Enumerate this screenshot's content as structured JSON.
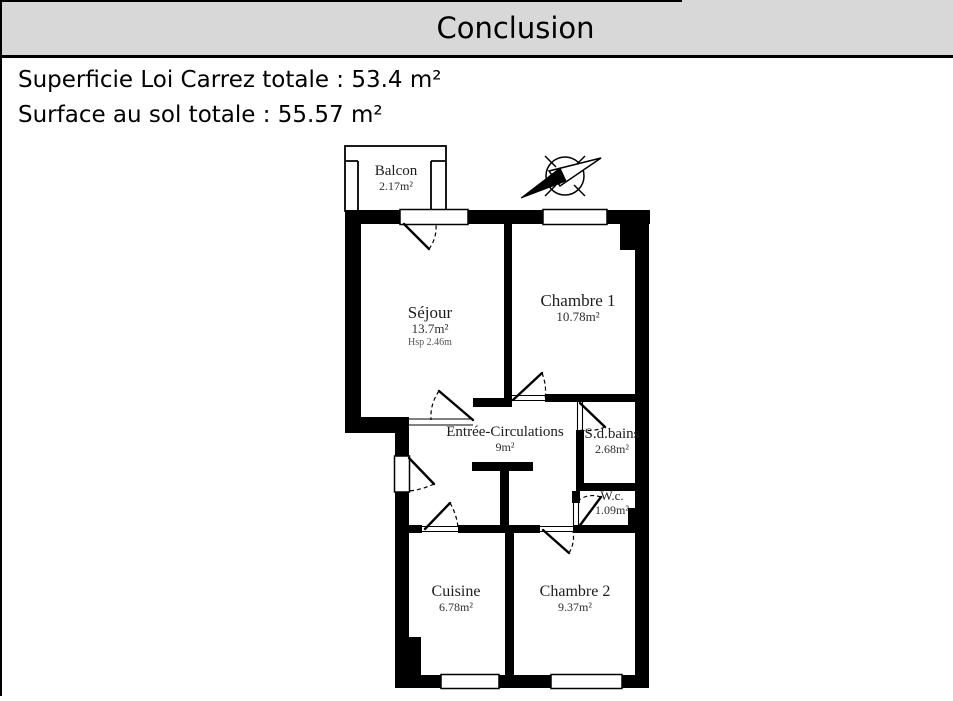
{
  "header": {
    "title": "Conclusion"
  },
  "summary": {
    "line1": "Superficie Loi Carrez totale : 53.4 m²",
    "line2": "Surface au sol totale : 55.57 m²"
  },
  "floorplan": {
    "icons": {
      "compass": "north-arrow-icon"
    },
    "rooms": {
      "balcon": {
        "name": "Balcon",
        "area": "2.17m²"
      },
      "sejour": {
        "name": "Séjour",
        "area": "13.7m²",
        "height": "Hsp 2.46m"
      },
      "chambre1": {
        "name": "Chambre 1",
        "area": "10.78m²"
      },
      "entree": {
        "name": "Entrée-Circulations",
        "area": "9m²"
      },
      "sdb": {
        "name": "S.d.bains",
        "area": "2.68m²"
      },
      "wc": {
        "name": "W.c.",
        "area": "1.09m²"
      },
      "cuisine": {
        "name": "Cuisine",
        "area": "6.78m²"
      },
      "chambre2": {
        "name": "Chambre 2",
        "area": "9.37m²"
      }
    }
  }
}
